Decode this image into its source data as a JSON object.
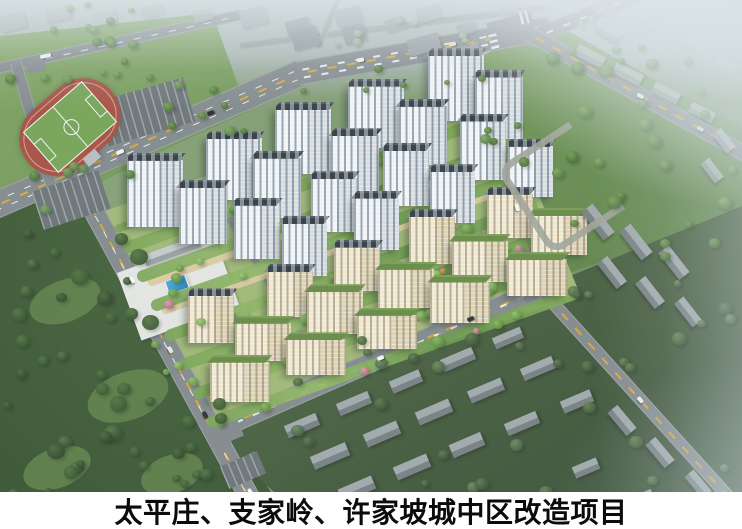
{
  "caption": {
    "text": "太平庄、支家岭、许家坡城中区改造项目"
  },
  "scene": {
    "description": "aerial architectural rendering of urban renewal residential project",
    "palette": {
      "road": "#868e92",
      "road_light": "#9aa3a4",
      "road_center_dash": "#d9a93f",
      "lane_dash": "rgba(240,244,244,0.9)",
      "facade_white": [
        "#eff3f5",
        "#d7dee2"
      ],
      "facade_cream": [
        "#efe8d3",
        "#dcd3b8"
      ],
      "roof_dark": "#3d444b",
      "roof_green": "#6c8f4e",
      "track_red": "#a9574a",
      "pitch_green": "#7aa65e",
      "pool_blue": "#3f9fd4",
      "path_tan": "#d8cba4",
      "caption_bg": "#fefefe",
      "caption_fg": "#0b0b0b"
    },
    "roads": [
      {
        "id": "avenue-west",
        "p1": [
          -30,
          216
        ],
        "p2": [
          302,
          72
        ],
        "w": 27,
        "lanes": 2,
        "yellow": true
      },
      {
        "id": "avenue-east",
        "p1": [
          298,
          73
        ],
        "p2": [
          550,
          28
        ],
        "w": 24,
        "lanes": 2,
        "yellow": true
      },
      {
        "id": "avenue-ne-branch",
        "p1": [
          527,
          40
        ],
        "p2": [
          672,
          -20
        ],
        "w": 16,
        "lanes": 1,
        "yellow": false
      },
      {
        "id": "park-road",
        "p1": [
          526,
          32
        ],
        "p2": [
          760,
          162
        ],
        "w": 16,
        "lanes": 0,
        "yellow": true
      },
      {
        "id": "north-road",
        "p1": [
          -12,
          70
        ],
        "p2": [
          242,
          14
        ],
        "w": 11,
        "lanes": 1,
        "yellow": false
      },
      {
        "id": "west-edge-road",
        "p1": [
          16,
          62
        ],
        "p2": [
          54,
          194
        ],
        "w": 12,
        "lanes": 0,
        "yellow": false
      },
      {
        "id": "west-boulevard",
        "p1": [
          84,
          192
        ],
        "p2": [
          270,
          534
        ],
        "w": 21,
        "lanes": 1,
        "yellow": true
      },
      {
        "id": "south-boulevard",
        "p1": [
          212,
          432
        ],
        "p2": [
          564,
          278
        ],
        "w": 20,
        "lanes": 1,
        "yellow": true
      },
      {
        "id": "east-road-upper",
        "p1": [
          470,
          60
        ],
        "p2": [
          542,
          290
        ],
        "w": 13,
        "lanes": 0,
        "yellow": true
      },
      {
        "id": "east-road-lower",
        "p1": [
          540,
          288
        ],
        "p2": [
          752,
          522
        ],
        "w": 13,
        "lanes": 0,
        "yellow": true
      },
      {
        "id": "top-road-1",
        "p1": [
          240,
          46
        ],
        "p2": [
          545,
          8
        ],
        "w": 8,
        "lanes": 0,
        "yellow": false,
        "light": true
      },
      {
        "id": "top-road-2",
        "p1": [
          318,
          48
        ],
        "p2": [
          340,
          -6
        ],
        "w": 7,
        "lanes": 0,
        "yellow": false,
        "light": true
      }
    ],
    "intersections": [
      [
        512,
        30,
        46,
        26,
        -15
      ],
      [
        88,
        196,
        34,
        24,
        -20
      ],
      [
        224,
        432,
        34,
        22,
        -23
      ],
      [
        549,
        283,
        24,
        18,
        -28
      ],
      [
        252,
        465,
        22,
        16,
        62
      ],
      [
        36,
        65,
        18,
        14,
        -12
      ]
    ],
    "zebras": [
      [
        494,
        42,
        16,
        8,
        76
      ],
      [
        90,
        186,
        16,
        8,
        64
      ],
      [
        524,
        17,
        8,
        14,
        -15
      ]
    ],
    "parking": [
      [
        145,
        112,
        92,
        46,
        -16
      ],
      [
        71,
        200,
        70,
        40,
        -18
      ],
      [
        243,
        470,
        40,
        24,
        -23
      ]
    ],
    "field": {
      "cx": 70,
      "cy": 127,
      "w": 110,
      "h": 74,
      "rot": -41
    },
    "blocks": [
      {
        "n": "plaza",
        "x": 178,
        "y": 289,
        "w": 104,
        "h": 72,
        "r": -20,
        "bg": "#e2e5e2"
      },
      {
        "n": "commercial-low-building",
        "x": 172,
        "y": 251,
        "w": 58,
        "h": 12,
        "r": -20,
        "bg": "linear-gradient(180deg,#c6ccce 0 55%,#9aa3a6 55%)"
      },
      {
        "n": "commercial-low-building",
        "x": 218,
        "y": 321,
        "w": 62,
        "h": 12,
        "r": -20,
        "bg": "linear-gradient(180deg,#c6ccce 0 55%,#9aa3a6 55%)"
      },
      {
        "n": "swimming-pool",
        "x": 176,
        "y": 283,
        "w": 20,
        "h": 13,
        "r": -20,
        "bg": "linear-gradient(135deg,#54b0dc,#2e85b6)",
        "bd": "1px solid #f2f6f6"
      },
      {
        "n": "pavilion",
        "x": 268,
        "y": 190,
        "w": 13,
        "h": 9,
        "r": -20,
        "bg": "#c89a62"
      },
      {
        "n": "red-roof-building",
        "x": 432,
        "y": 110,
        "w": 15,
        "h": 10,
        "r": -20,
        "bg": "#a84c40"
      },
      {
        "n": "grandstand",
        "x": 92,
        "y": 158,
        "w": 16,
        "h": 10,
        "r": -40,
        "bg": "#b9bfc1"
      }
    ],
    "cwall": {
      "x": 557,
      "y": 182,
      "w": 80,
      "h": 90,
      "rot": -33,
      "color": "#a2a79d"
    },
    "complex": {
      "origin": [
        110,
        222
      ],
      "u": [
        372,
        -132
      ],
      "v": [
        98,
        204
      ],
      "rows": 7,
      "cols": 5,
      "row_heights": [
        64,
        60,
        56,
        52,
        46,
        42,
        38
      ],
      "bldg_w": [
        56,
        48,
        46,
        45,
        46,
        56,
        60
      ],
      "facade": [
        "w",
        "w",
        "w",
        "w",
        "c",
        "c",
        "c"
      ],
      "roof": [
        "d",
        "d",
        "d",
        "d",
        "d",
        "g",
        "g"
      ],
      "stagger": 0.09,
      "skip": [
        [
          2,
          0
        ],
        [
          3,
          0
        ]
      ],
      "paths_v": [
        0.31,
        0.45
      ],
      "internal_roads": [
        0.27,
        0.58,
        0.8
      ]
    },
    "oldtown": [
      [
        302,
        425,
        34,
        13,
        -23,
        0
      ],
      [
        354,
        403,
        34,
        13,
        -23,
        0
      ],
      [
        406,
        381,
        32,
        13,
        -23,
        0
      ],
      [
        458,
        359,
        34,
        13,
        -23,
        0
      ],
      [
        508,
        338,
        30,
        12,
        -23,
        0
      ],
      [
        330,
        456,
        38,
        14,
        -23,
        0
      ],
      [
        382,
        434,
        36,
        14,
        -23,
        0
      ],
      [
        434,
        412,
        36,
        14,
        -23,
        0
      ],
      [
        486,
        390,
        36,
        13,
        -23,
        0
      ],
      [
        538,
        368,
        34,
        13,
        -23,
        0
      ],
      [
        357,
        489,
        36,
        14,
        -23,
        0
      ],
      [
        412,
        467,
        36,
        14,
        -23,
        0
      ],
      [
        467,
        445,
        34,
        14,
        -23,
        0
      ],
      [
        522,
        423,
        34,
        13,
        -23,
        0
      ],
      [
        577,
        401,
        32,
        13,
        -23,
        0
      ],
      [
        622,
        420,
        30,
        13,
        50,
        0
      ],
      [
        660,
        452,
        30,
        13,
        50,
        0
      ],
      [
        698,
        484,
        28,
        12,
        50,
        0
      ],
      [
        586,
        468,
        26,
        12,
        -23,
        0
      ],
      [
        640,
        500,
        28,
        12,
        -23,
        0
      ],
      [
        598,
        222,
        36,
        14,
        52,
        0
      ],
      [
        636,
        242,
        36,
        14,
        52,
        0
      ],
      [
        674,
        262,
        34,
        13,
        52,
        0
      ],
      [
        612,
        272,
        32,
        13,
        52,
        0
      ],
      [
        650,
        292,
        32,
        13,
        52,
        0
      ],
      [
        688,
        312,
        30,
        12,
        52,
        0
      ],
      [
        590,
        56,
        30,
        12,
        27,
        1
      ],
      [
        628,
        74,
        30,
        12,
        27,
        1
      ],
      [
        666,
        93,
        28,
        12,
        27,
        1
      ],
      [
        702,
        112,
        26,
        11,
        27,
        1
      ],
      [
        608,
        32,
        26,
        11,
        27,
        1
      ],
      [
        724,
        140,
        24,
        11,
        52,
        1
      ],
      [
        712,
        170,
        24,
        11,
        52,
        1
      ]
    ],
    "cityblocks": [
      [
        12,
        22,
        26,
        16,
        -15,
        "#aab4b2",
        0.9
      ],
      [
        58,
        14,
        24,
        13,
        -15,
        "#a8b2b0",
        0.85
      ],
      [
        104,
        17,
        24,
        13,
        -15,
        "#adb7b5",
        0.8
      ],
      [
        152,
        11,
        22,
        12,
        -15,
        "#a6b0ae",
        0.8
      ],
      [
        203,
        15,
        20,
        12,
        -15,
        "#a3adab",
        0.75
      ],
      [
        253,
        17,
        26,
        18,
        -15,
        "#9faaac",
        0.9
      ],
      [
        298,
        26,
        24,
        15,
        -15,
        "#929da0",
        0.95
      ],
      [
        348,
        16,
        26,
        16,
        -15,
        "#9aa5a7",
        0.9
      ],
      [
        395,
        24,
        20,
        13,
        -15,
        "#97a2a4",
        0.85
      ],
      [
        428,
        13,
        24,
        15,
        -15,
        "#a0abad",
        0.8
      ],
      [
        466,
        28,
        18,
        11,
        -15,
        "#9aa4a6",
        0.8
      ],
      [
        508,
        9,
        20,
        12,
        -15,
        "#a7b1b3",
        0.7
      ],
      [
        305,
        38,
        26,
        20,
        -15,
        "#8d989b",
        1
      ],
      [
        354,
        34,
        22,
        18,
        -15,
        "#909b9e",
        1
      ],
      [
        424,
        44,
        32,
        17,
        -15,
        "#95a0a3",
        0.95
      ],
      [
        468,
        52,
        24,
        14,
        -15,
        "#98a3a6",
        0.9
      ],
      [
        652,
        20,
        28,
        14,
        28,
        "#b2bbbd",
        0.55
      ],
      [
        696,
        42,
        24,
        12,
        28,
        "#b5bec0",
        0.5
      ],
      [
        726,
        66,
        22,
        12,
        28,
        "#b8c1c3",
        0.45
      ],
      [
        604,
        8,
        22,
        11,
        28,
        "#b0b9bb",
        0.5
      ]
    ],
    "tree_regions": [
      {
        "x": 0,
        "y": 228,
        "w": 148,
        "h": 290,
        "n": 38,
        "pal": "dark",
        "smin": 9,
        "smax": 19
      },
      {
        "x": 148,
        "y": 382,
        "w": 78,
        "h": 110,
        "n": 9,
        "pal": "dark",
        "smin": 8,
        "smax": 14
      },
      {
        "x": 128,
        "y": 55,
        "w": 112,
        "h": 95,
        "n": 9,
        "pal": "mid",
        "smin": 7,
        "smax": 13
      },
      {
        "x": 4,
        "y": 28,
        "w": 122,
        "h": 48,
        "n": 8,
        "pal": "mid",
        "smin": 6,
        "smax": 11
      },
      {
        "x": 22,
        "y": 158,
        "w": 112,
        "h": 48,
        "n": 6,
        "pal": "mid",
        "smin": 7,
        "smax": 12
      },
      {
        "x": 148,
        "y": 238,
        "w": 62,
        "h": 148,
        "n": 7,
        "pal": "bright",
        "smin": 6,
        "smax": 11
      },
      {
        "x": 544,
        "y": 52,
        "w": 196,
        "h": 212,
        "n": 24,
        "pal": "mid",
        "smin": 8,
        "smax": 16
      },
      {
        "x": 478,
        "y": 74,
        "w": 62,
        "h": 112,
        "n": 6,
        "pal": "mid",
        "smin": 7,
        "smax": 12
      },
      {
        "x": 282,
        "y": 330,
        "w": 458,
        "h": 160,
        "n": 26,
        "pal": "muted",
        "smin": 8,
        "smax": 15
      },
      {
        "x": 558,
        "y": 250,
        "w": 178,
        "h": 72,
        "n": 7,
        "pal": "muted",
        "smin": 7,
        "smax": 13
      },
      {
        "x": 0,
        "y": 0,
        "w": 132,
        "h": 42,
        "n": 9,
        "pal": "mid",
        "smin": 6,
        "smax": 11
      },
      {
        "x": 238,
        "y": 18,
        "w": 262,
        "h": 30,
        "n": 7,
        "pal": "pale",
        "smin": 5,
        "smax": 9
      },
      {
        "x": 552,
        "y": 4,
        "w": 64,
        "h": 26,
        "n": 3,
        "pal": "pale",
        "smin": 5,
        "smax": 8
      },
      {
        "x": 542,
        "y": 38,
        "w": 124,
        "h": 26,
        "n": 4,
        "pal": "mid",
        "smin": 5,
        "smax": 9
      },
      {
        "x": 300,
        "y": 62,
        "w": 170,
        "h": 28,
        "n": 5,
        "pal": "mid",
        "smin": 5,
        "smax": 9
      }
    ],
    "tree_palettes": {
      "dark": [
        [
          "#5d7f50",
          "#3d5837"
        ],
        [
          "#587a4b",
          "#415f3a"
        ],
        [
          "#527148",
          "#384f33"
        ]
      ],
      "mid": [
        [
          "#7da45e",
          "#567a47"
        ],
        [
          "#85ad66",
          "#5d8350"
        ],
        [
          "#74a058",
          "#4e7242"
        ]
      ],
      "bright": [
        [
          "#96c270",
          "#6d9a50"
        ],
        [
          "#a2cb7a",
          "#76a55a"
        ],
        [
          "#8cb868",
          "#649147"
        ]
      ],
      "muted": [
        [
          "#6d8a5c",
          "#4b6343"
        ],
        [
          "#64815a",
          "#44593f"
        ],
        [
          "#72906a",
          "#50684a"
        ]
      ],
      "pale": [
        [
          "#a9bba4",
          "#8ba18a"
        ],
        [
          "#b2c2ad",
          "#93a892"
        ]
      ],
      "pink": [
        "#d3a3ab",
        "#b27781"
      ],
      "orange": [
        "#d8a45e",
        "#b07a3e"
      ]
    },
    "cars": [
      [
        120,
        152,
        -23,
        "#f2f4f4",
        8
      ],
      [
        210,
        113,
        -23,
        "#2f363a",
        7
      ],
      [
        360,
        60,
        -10,
        "#f2f4f4",
        7
      ],
      [
        452,
        44,
        -10,
        "#dfe3e3",
        7
      ],
      [
        45,
        56,
        -12,
        "#eef1f1",
        11
      ],
      [
        640,
        96,
        29,
        "#f2f4f4",
        7
      ],
      [
        700,
        129,
        29,
        "#d8dcdc",
        7
      ],
      [
        132,
        280,
        62,
        "#f2f4f4",
        7
      ],
      [
        170,
        350,
        61,
        "#e4e7e7",
        7
      ],
      [
        205,
        415,
        61,
        "#313a3e",
        7
      ],
      [
        380,
        358,
        -23,
        "#f2f4f4",
        7
      ],
      [
        470,
        319,
        -23,
        "#343b3f",
        7
      ],
      [
        517,
        208,
        72,
        "#f2f4f4",
        7
      ],
      [
        640,
        400,
        48,
        "#eceeee",
        7
      ],
      [
        250,
        492,
        60,
        "#f0f2f2",
        7
      ]
    ]
  }
}
